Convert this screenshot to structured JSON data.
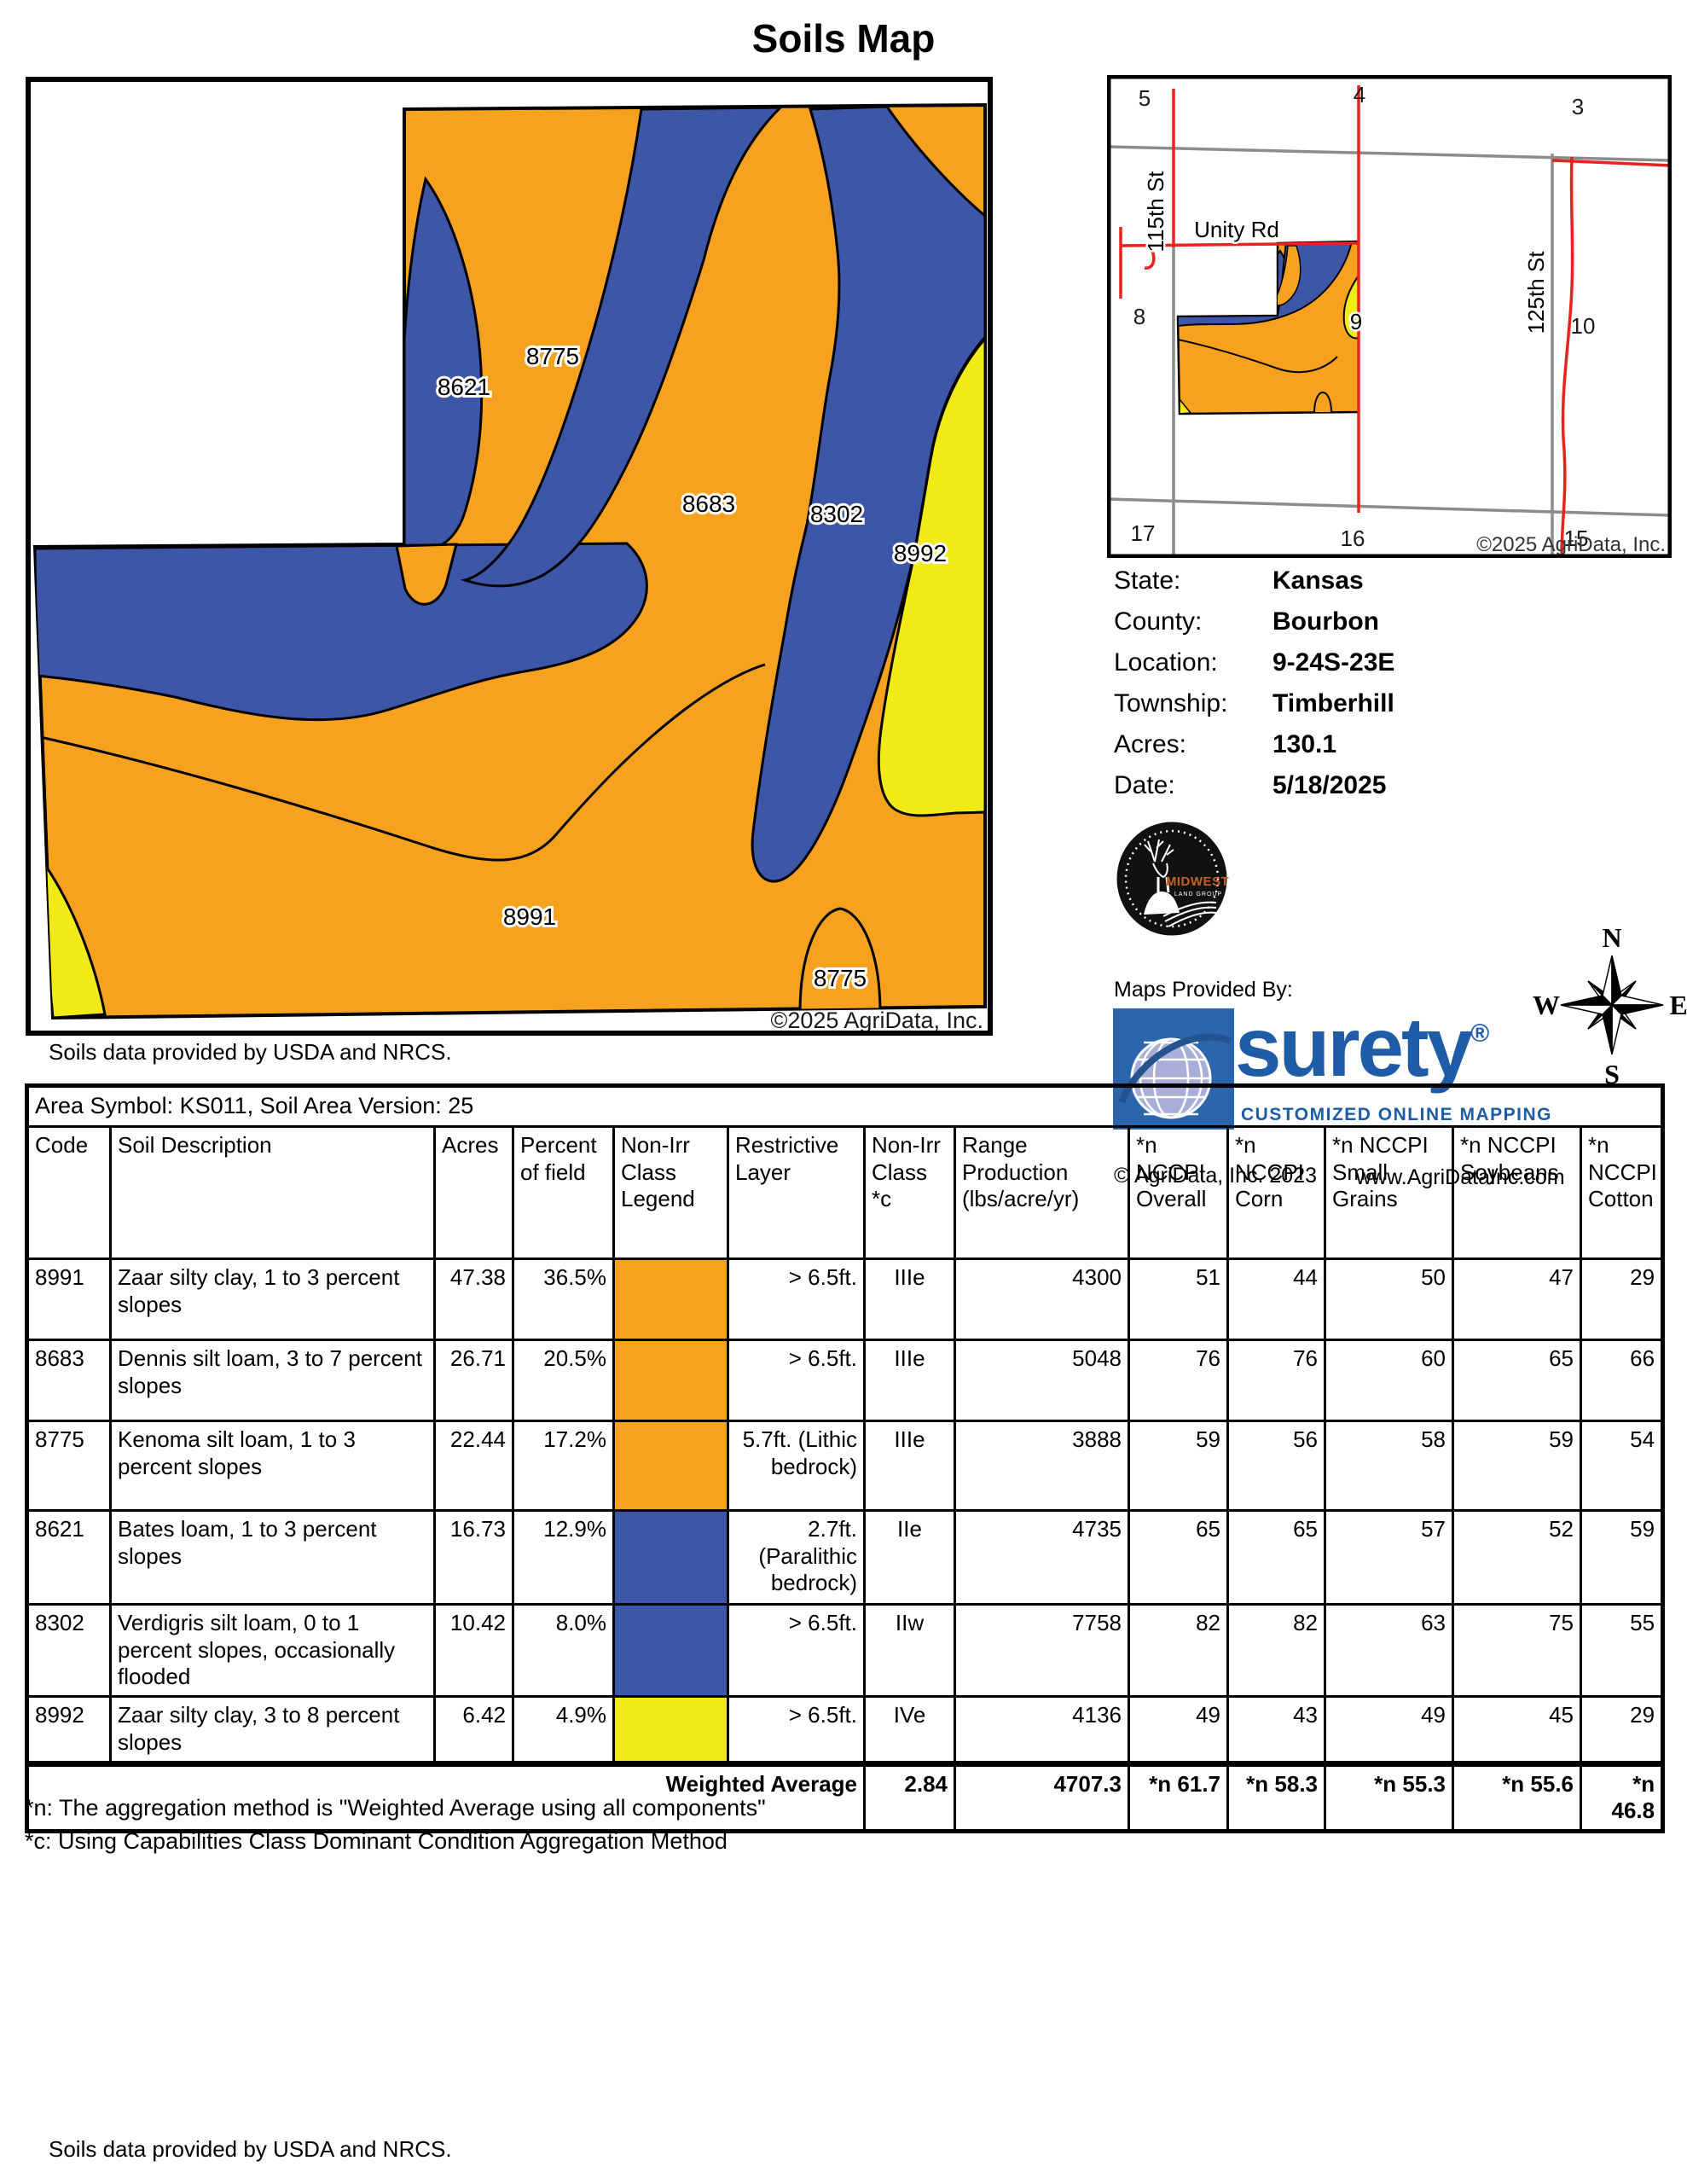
{
  "title": "Soils Map",
  "main_map": {
    "labels": [
      "8775",
      "8621",
      "8683",
      "8302",
      "8992",
      "8991",
      "8775"
    ],
    "copyright": "©2025 AgriData, Inc.",
    "caption": "Soils data provided by USDA and NRCS."
  },
  "locator_map": {
    "section_numbers": [
      "5",
      "4",
      "3",
      "8",
      "9",
      "10",
      "17",
      "16",
      "15"
    ],
    "roads": {
      "unity": "Unity Rd",
      "st115": "115th St",
      "st125": "125th St"
    },
    "copyright": "©2025 AgriData, Inc."
  },
  "info": {
    "rows": [
      {
        "label": "State:",
        "value": "Kansas"
      },
      {
        "label": "County:",
        "value": "Bourbon"
      },
      {
        "label": "Location:",
        "value": "9-24S-23E"
      },
      {
        "label": "Township:",
        "value": "Timberhill"
      },
      {
        "label": "Acres:",
        "value": "130.1"
      },
      {
        "label": "Date:",
        "value": "5/18/2025"
      }
    ]
  },
  "branding": {
    "maps_provided_by": "Maps Provided By:",
    "midwest": {
      "name": "MIDWEST",
      "sub": "LAND GROUP"
    },
    "surety": {
      "word": "surety",
      "reg": "®",
      "tagline": "CUSTOMIZED ONLINE MAPPING",
      "copyright": "© AgriData, Inc. 2023",
      "url": "www.AgriDataInc.com"
    }
  },
  "compass": {
    "n": "N",
    "e": "E",
    "s": "S",
    "w": "W"
  },
  "soils_table": {
    "area_symbol_line": "Area Symbol: KS011, Soil Area Version: 25",
    "columns": [
      "Code",
      "Soil Description",
      "Acres",
      "Percent of field",
      "Non-Irr Class Legend",
      "Restrictive Layer",
      "Non-Irr Class *c",
      "Range Production (lbs/acre/yr)",
      "*n NCCPI Overall",
      "*n NCCPI Corn",
      "*n NCCPI Small Grains",
      "*n NCCPI Soybeans",
      "*n NCCPI Cotton"
    ],
    "rows": [
      {
        "code": "8991",
        "description": "Zaar silty clay, 1 to 3 percent slopes",
        "acres": "47.38",
        "percent": "36.5%",
        "legend_color": "#F7A21E",
        "restrictive": "> 6.5ft.",
        "non_irr_class": "IIIe",
        "range_production": "4300",
        "overall": "51",
        "corn": "44",
        "small_grains": "50",
        "soybeans": "47",
        "cotton": "29"
      },
      {
        "code": "8683",
        "description": "Dennis silt loam, 3 to 7 percent slopes",
        "acres": "26.71",
        "percent": "20.5%",
        "legend_color": "#F7A21E",
        "restrictive": "> 6.5ft.",
        "non_irr_class": "IIIe",
        "range_production": "5048",
        "overall": "76",
        "corn": "76",
        "small_grains": "60",
        "soybeans": "65",
        "cotton": "66"
      },
      {
        "code": "8775",
        "description": "Kenoma silt loam, 1 to 3 percent slopes",
        "acres": "22.44",
        "percent": "17.2%",
        "legend_color": "#F7A21E",
        "restrictive": "5.7ft. (Lithic bedrock)",
        "non_irr_class": "IIIe",
        "range_production": "3888",
        "overall": "59",
        "corn": "56",
        "small_grains": "58",
        "soybeans": "59",
        "cotton": "54"
      },
      {
        "code": "8621",
        "description": "Bates loam, 1 to 3 percent slopes",
        "acres": "16.73",
        "percent": "12.9%",
        "legend_color": "#3D56A8",
        "restrictive": "2.7ft. (Paralithic bedrock)",
        "non_irr_class": "IIe",
        "range_production": "4735",
        "overall": "65",
        "corn": "65",
        "small_grains": "57",
        "soybeans": "52",
        "cotton": "59"
      },
      {
        "code": "8302",
        "description": "Verdigris silt loam, 0 to 1 percent slopes, occasionally flooded",
        "acres": "10.42",
        "percent": "8.0%",
        "legend_color": "#3D56A8",
        "restrictive": "> 6.5ft.",
        "non_irr_class": "IIw",
        "range_production": "7758",
        "overall": "82",
        "corn": "82",
        "small_grains": "63",
        "soybeans": "75",
        "cotton": "55"
      },
      {
        "code": "8992",
        "description": "Zaar silty clay, 3 to 8 percent slopes",
        "acres": "6.42",
        "percent": "4.9%",
        "legend_color": "#F2EA16",
        "restrictive": "> 6.5ft.",
        "non_irr_class": "IVe",
        "range_production": "4136",
        "overall": "49",
        "corn": "43",
        "small_grains": "49",
        "soybeans": "45",
        "cotton": "29"
      }
    ],
    "weighted": {
      "label": "Weighted Average",
      "non_irr_class": "2.84",
      "range_production": "4707.3",
      "overall": "*n 61.7",
      "corn": "*n 58.3",
      "small_grains": "*n 55.3",
      "soybeans": "*n 55.6",
      "cotton": "*n 46.8"
    }
  },
  "footnotes": [
    "*n: The aggregation method is \"Weighted Average using all components\"",
    "*c: Using Capabilities Class Dominant Condition Aggregation Method"
  ],
  "footer": "Soils data provided by USDA and NRCS.",
  "colors": {
    "soil_orange": "#F7A21E",
    "soil_blue": "#3D56A8",
    "soil_yellow": "#F2EA16",
    "road_red": "#E8231F",
    "road_gray": "#8C8C8C",
    "surety_blue": "#1E5CA8"
  }
}
